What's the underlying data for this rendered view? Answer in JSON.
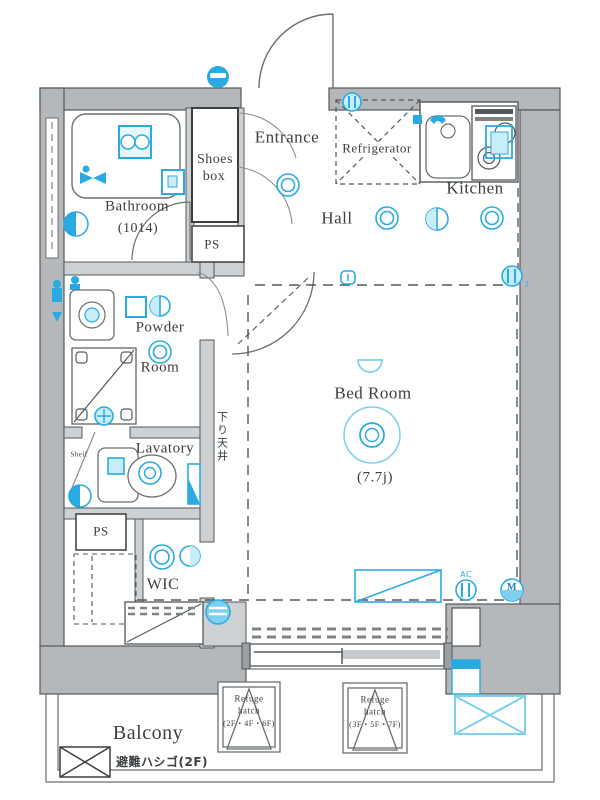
{
  "plan": {
    "colors": {
      "accent": "#29abe2",
      "accent_light": "#c9ecf9",
      "wall_gray": "#b4b8ba",
      "line": "#53585b"
    },
    "rooms": {
      "bathroom": "Bathroom",
      "bathroom_size": "(1014)",
      "shoes_line1": "Shoes",
      "shoes_line2": "box",
      "ps_upper": "PS",
      "entrance": "Entrance",
      "refrigerator": "Refrigerator",
      "kitchen": "Kitchen",
      "hall": "Hall",
      "powder_line1": "Powder",
      "powder_line2": "Room",
      "lavatory": "Lavatory",
      "shelf": "Shelf",
      "ps_lower": "PS",
      "wic": "WIC",
      "bedroom": "Bed Room",
      "bedroom_size": "(7.7j)",
      "balcony": "Balcony"
    },
    "annotations": {
      "lowered_ceiling": "下り天井",
      "ac": "AC",
      "meter": "M",
      "outlet_count": "2",
      "refuge1_line1": "Refuge",
      "refuge1_line2": "hatch",
      "refuge1_line3": "(2F・4F・6F)",
      "refuge2_line1": "Refuge",
      "refuge2_line2": "hatch",
      "refuge2_line3": "(3F・5F・7F)",
      "ladder": "避難ハシゴ(2F)"
    }
  }
}
